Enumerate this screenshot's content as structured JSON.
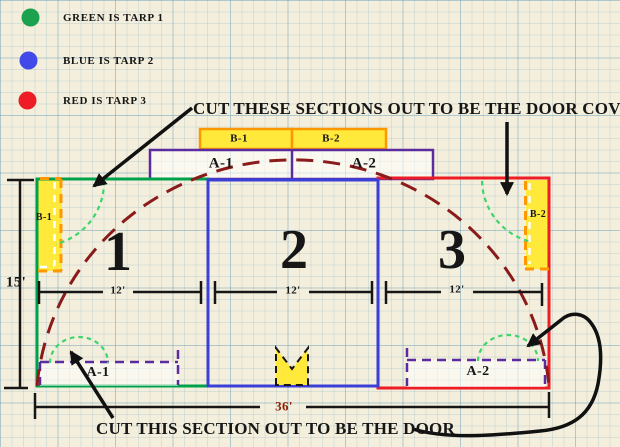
{
  "legend": {
    "items": [
      {
        "label": "GREEN IS TARP 1",
        "color": "#1ca24e"
      },
      {
        "label": "BLUE IS TARP 2",
        "color": "#4149e8"
      },
      {
        "label": "RED IS TARP 3",
        "color": "#ee1c25"
      }
    ]
  },
  "annotations": {
    "door_cover": "CUT THESE SECTIONS OUT TO BE THE DOOR COVER",
    "door": "CUT THIS SECTION OUT TO BE THE DOOR"
  },
  "diagram": {
    "sections": [
      {
        "number": "1",
        "width": "12'"
      },
      {
        "number": "2",
        "width": "12'"
      },
      {
        "number": "3",
        "width": "12'"
      }
    ],
    "height": "15'",
    "total_width": "36'",
    "door_cover_panels": {
      "top_left": "B-1",
      "top_right": "B-2",
      "left": "B-1",
      "right": "B-2"
    },
    "door_panels": {
      "upper_left": "A-1",
      "upper_right": "A-2",
      "lower_left": "A-1",
      "lower_right": "A-2"
    },
    "colors": {
      "tarp1": "#00A14B",
      "tarp2": "#3A3FD9",
      "tarp3": "#EE1C25",
      "door_outline_purple": "#5A2CA0",
      "cutout_fill_yellow": "#FFE93B",
      "cutout_border_orange": "#FF9800",
      "arch_dashed": "#8B1A1A",
      "fold_arc_green": "#3FD46C"
    }
  }
}
